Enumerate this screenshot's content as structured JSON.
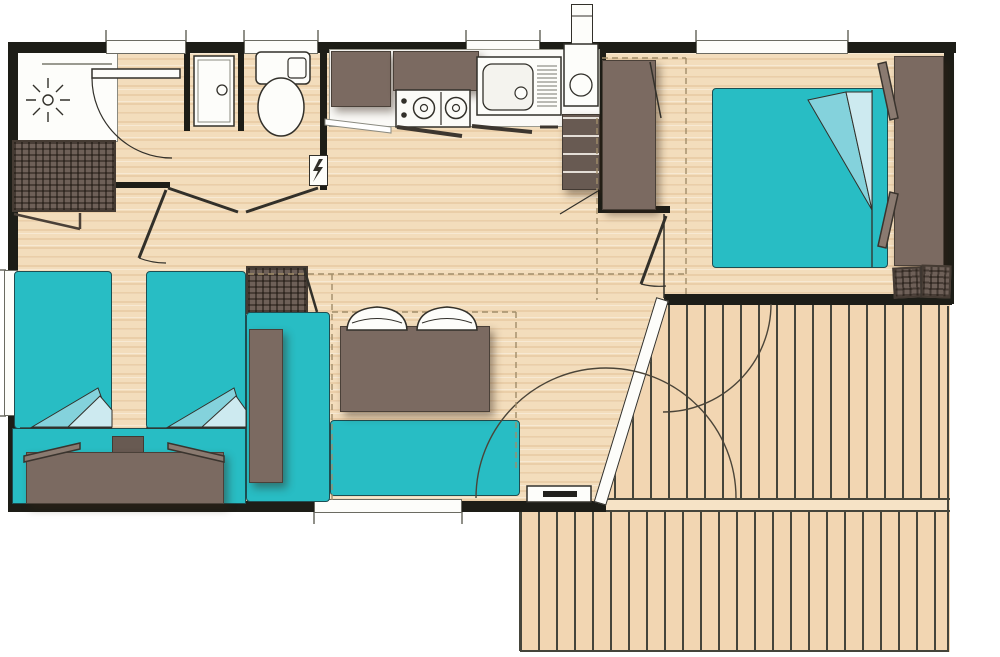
{
  "document": {
    "type": "floor-plan",
    "subject": "mobile-home layout with deck",
    "visible_text": []
  },
  "palette": {
    "paper": "#ffffff",
    "wall": "#1d1d17",
    "ink": "#32302a",
    "floor": "#f3ddbc",
    "deck": "#f2d6b2",
    "deckline": "#45453b",
    "teal": "#28bdc4",
    "tealmid": "#84d2dc",
    "teallight": "#cdeaf0",
    "brown": "#7b6a61",
    "browndark": "#685a52",
    "uph": "#6e6058",
    "fixture": "#fdfdfa",
    "dashline": "#a18d69"
  },
  "rooms": [
    {
      "name": "bathroom",
      "features": [
        "shower",
        "washbasin-cabinet",
        "storage-unit",
        "hinged-door"
      ]
    },
    {
      "name": "wc",
      "features": [
        "toilet-with-cistern",
        "hinged-door"
      ]
    },
    {
      "name": "kitchen",
      "features": [
        "wall-cabinet",
        "extractor-hood",
        "cooktop-2-burners",
        "sink-with-drainboard",
        "water-heater",
        "roof-vent",
        "fridge",
        "electrical-panel"
      ]
    },
    {
      "name": "master-bedroom",
      "features": [
        "double-bed",
        "folded-blanket",
        "wardrobe",
        "headboard",
        "pillows",
        "cushions",
        "hinged-door"
      ]
    },
    {
      "name": "twin-bedroom",
      "features": [
        "single-bed",
        "single-bed",
        "folded-blankets",
        "nightstand",
        "shared-headboard",
        "pillows",
        "storage-unit",
        "hinged-door"
      ]
    },
    {
      "name": "living-dining",
      "features": [
        "corner-sofa",
        "bench-table",
        "dining-table",
        "chair",
        "chair",
        "tv-unit"
      ]
    },
    {
      "name": "deck",
      "features": [
        "vertical-planks",
        "open-patio-door",
        "door-swing-arcs"
      ]
    }
  ],
  "openings": {
    "windows_top_wall": 4,
    "windows_left_wall": 1,
    "windows_bottom_wall": 1,
    "doors": [
      "bathroom-door",
      "wc-door",
      "twin-bedroom-door",
      "master-bedroom-door",
      "patio-door"
    ]
  }
}
